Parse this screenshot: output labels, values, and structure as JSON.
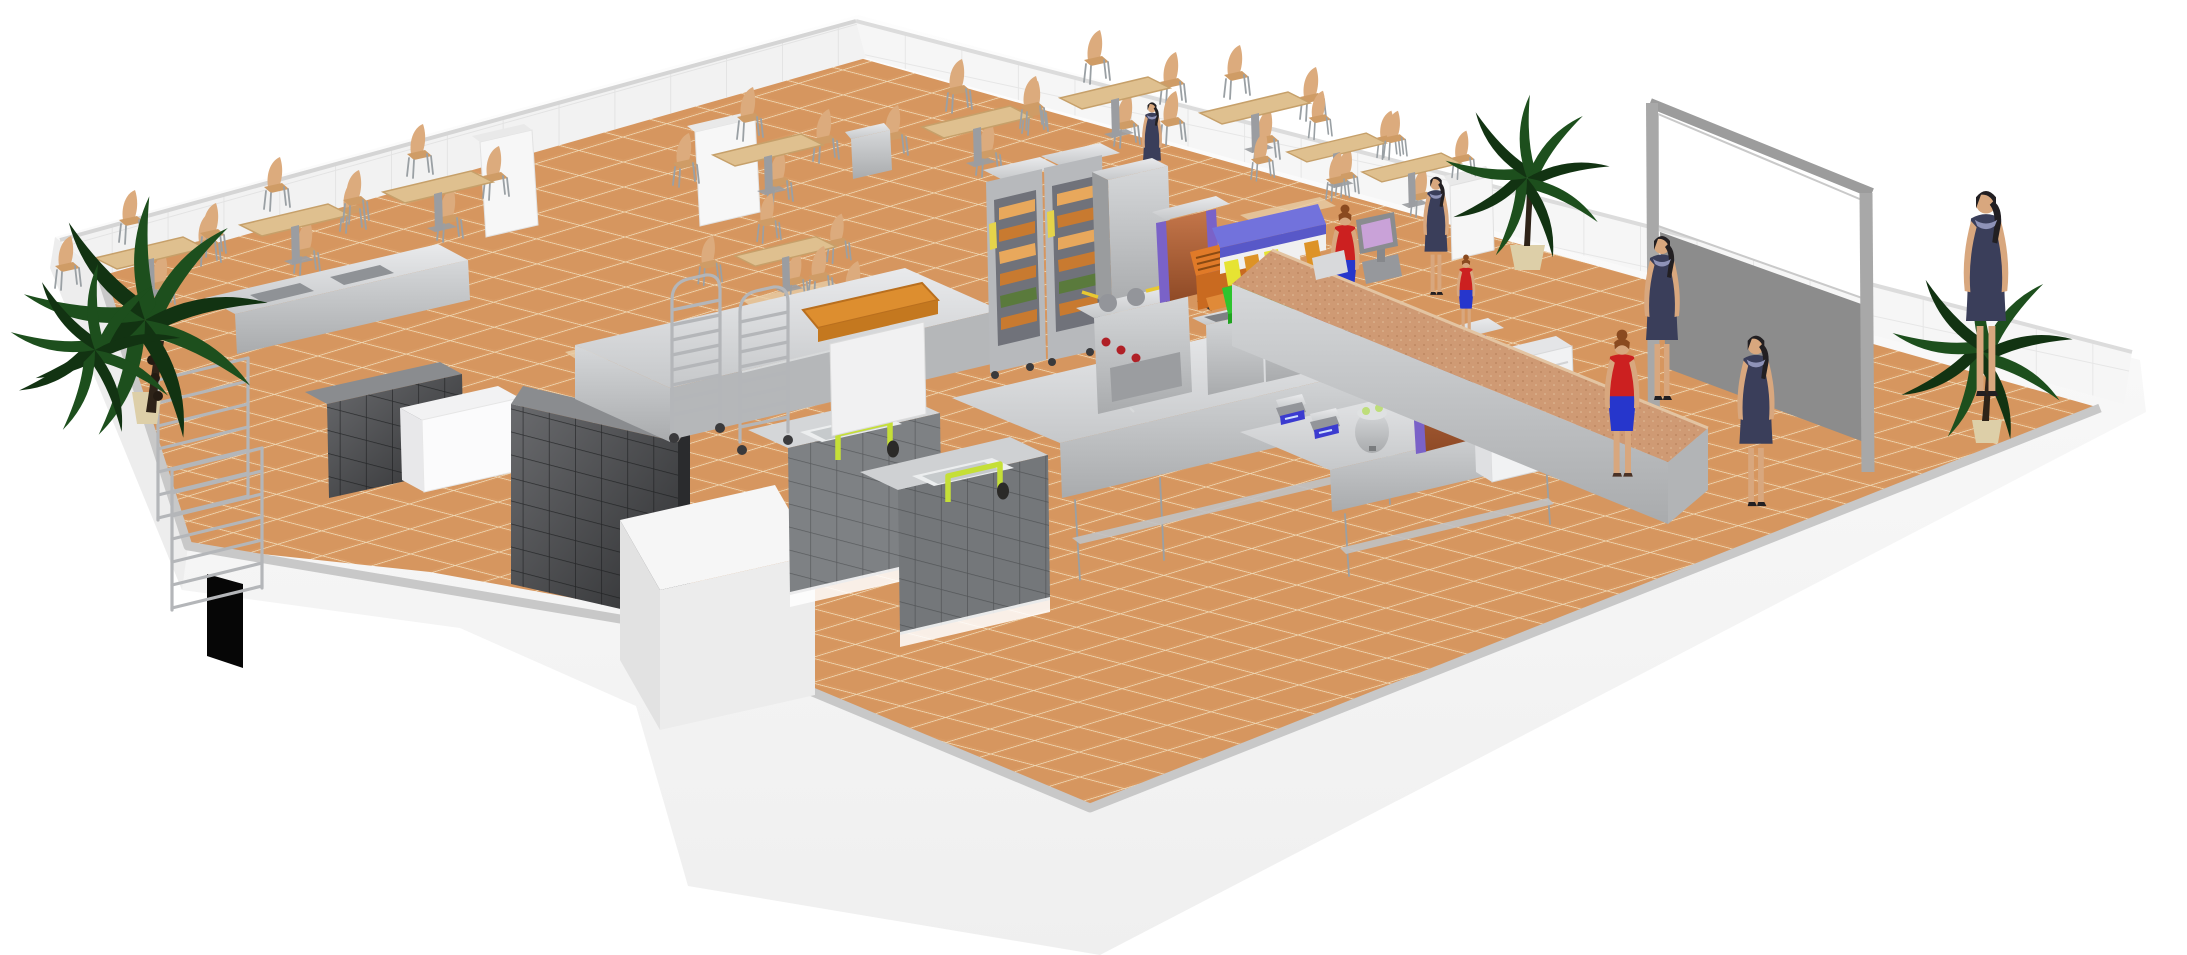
{
  "meta": {
    "description": "3D isometric cutaway rendering of a self-service restaurant floor plan: terracotta-tiled dining area with light wood tables and chairs, white tiled cutaway walls, commercial kitchen with stainless steel equipment, self-service line with colored tray stacks, granite cashier counter, staff in red uniforms, customers in navy dresses, potted palms and a blank menu board screen",
    "background_color": "#ffffff"
  },
  "colors": {
    "background": "#ffffff",
    "silhouette": "#fafafa",
    "wall_face": "#f2f2f2",
    "wall_line": "#e3e3e3",
    "wall_top": "#c8c8c8",
    "wall_outer": "#ededed",
    "floor_tile": "#d99a63",
    "floor_grout": "#eed6b2",
    "floor_patch": "#e7cda6",
    "dark_block_top": "#8a8c8f",
    "dark_block_front": "#3c3d40",
    "dark_block_side": "#2a2b2d",
    "steel_light": "#e4e5e7",
    "steel_mid": "#c2c4c7",
    "steel_dark": "#93959a",
    "wire_rack": "#b4b6b9",
    "wood_table": "#dfc08f",
    "wood_table_edge": "#c6a06a",
    "chair_wood": "#dcab7d",
    "chair_wood2": "#cf9c66",
    "leg_gray": "#9aa0a4",
    "butcher_top": "#dd8e2f",
    "oven_body": "#b7b9bc",
    "oven_door": "#70727a",
    "food_a": "#c87a30",
    "food_b": "#e8a85c",
    "food_green": "#5a7a3c",
    "label_yellow": "#e5d44a",
    "copper": "#a85a32",
    "purple_trim": "#7a62c8",
    "tray_blue": "#7272dc",
    "tray_green": "#2ec42e",
    "tray_yellow": "#e6e332",
    "tray_orange": "#dd9327",
    "tray_white": "#f0f0f0",
    "bin_red": "#cc2424",
    "faucet_green": "#c5df37",
    "faucet_head": "#2b2a28",
    "scale_display": "#3b3bd0",
    "register_screen": "#c9a2d8",
    "register_body": "#96989c",
    "granite": "#cf9a74",
    "granite_speck": "#b07a52",
    "ice_white": "#f1f2f3",
    "skin": "#d8a77e",
    "staff_red": "#cc2020",
    "staff_blue": "#2636cc",
    "customer_navy": "#3a3e5a",
    "hair_auburn": "#8a4a20",
    "hair_dark": "#221f22",
    "plant_green": "#1d4f1d",
    "plant_dark": "#123312",
    "trunk": "#2e2318",
    "pot_tan": "#ddcfa8",
    "frame_gray": "#a5a5a5",
    "panel_gray": "#8c8c8c",
    "screen_white": "#ffffff",
    "doorway": "#060606"
  },
  "scene": {
    "view": "isometric cutaway, white void background",
    "rooms": [
      {
        "name": "dining-area",
        "floor": "terracotta tile",
        "tables": 10,
        "chair_style": "light bentwood",
        "plants": 1
      },
      {
        "name": "kitchen",
        "floor": "terracotta tile",
        "equipment": [
          "wire-shelving-racks",
          "stainless-sink-counter",
          "dark-tiled-cold-room",
          "white-walk-in-store",
          "wash-sinks-with-green-faucets",
          "stainless-prep-islands",
          "tray-trolleys",
          "butcher-block-table",
          "combi-ovens-with-food",
          "cooking-range-red-knobs",
          "double-deep-fryers",
          "digital-scales",
          "rice-cooker"
        ]
      },
      {
        "name": "serving-line",
        "equipment": [
          "copper-hot-dispenser",
          "conveyor-toaster",
          "colored-tray-stack",
          "waste-bin",
          "bain-marie-counter",
          "copper-soup-kettle",
          "ice-machine",
          "cash-register"
        ]
      },
      {
        "name": "customer-corridor",
        "features": [
          "granite-service-counter",
          "menu-board-screen",
          "gray-partition-wall",
          "potted-palm",
          "white-display-cube",
          "wall-doorway"
        ]
      }
    ],
    "people": [
      {
        "name": "staff",
        "outfit": "red top, cobalt skirt, auburn bun",
        "count": 3
      },
      {
        "name": "customers",
        "outfit": "navy dress, dark ponytail, heels",
        "count": 5
      }
    ],
    "plants": {
      "count": 3,
      "type": "potted palm"
    }
  }
}
